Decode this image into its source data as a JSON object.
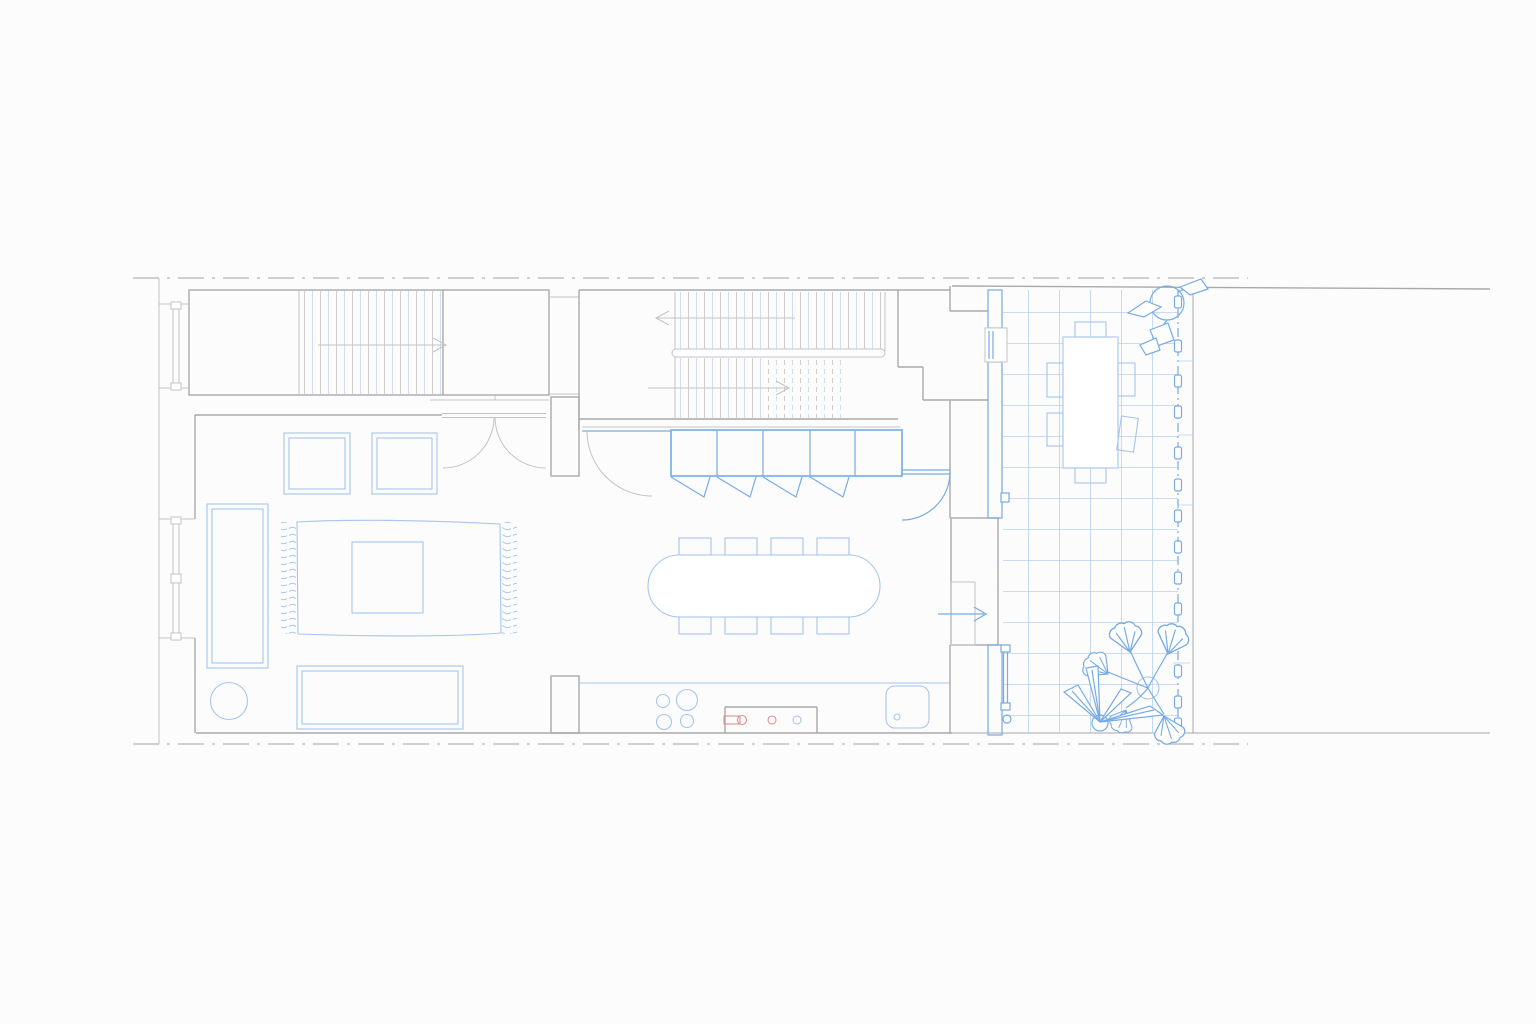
{
  "page": {
    "description": "Architectural ground-floor plan of a narrow terraced house with rear garden terrace",
    "visible_text": []
  },
  "colors": {
    "bg": "#fcfcfc",
    "wall": "#a9a9ab",
    "wall-light": "#c3c3c5",
    "boundary": "#b4b4b6",
    "blue": "#76abe4",
    "blue-soft": "#a5c6ee",
    "blue-grid": "#b7d2f0",
    "tread-gray": "#cdcdcf",
    "tread-blue": "#cfdef2",
    "red": "#e09090"
  },
  "inventory": {
    "stair_runs": 3,
    "direction_arrows": 4,
    "double_doors": 1,
    "single_doors": 2,
    "windows": 4,
    "living_room": {
      "sofas": 2,
      "armchairs": 2,
      "coffee_tables": 1,
      "rugs": 1,
      "round_side_tables": 1
    },
    "dining": {
      "tables": 1,
      "chairs": 8
    },
    "kitchen": {
      "cabinet_sections": 5,
      "bifold_fronts": 4,
      "hob_burners": 4,
      "sinks": 1,
      "faucet_parts": 3
    },
    "terrace": {
      "tile_grid": true,
      "outdoor_tables": 1,
      "outdoor_chairs": 6,
      "plants": 3,
      "fence_posts": 14,
      "hatched_wall_segments": 3
    }
  }
}
